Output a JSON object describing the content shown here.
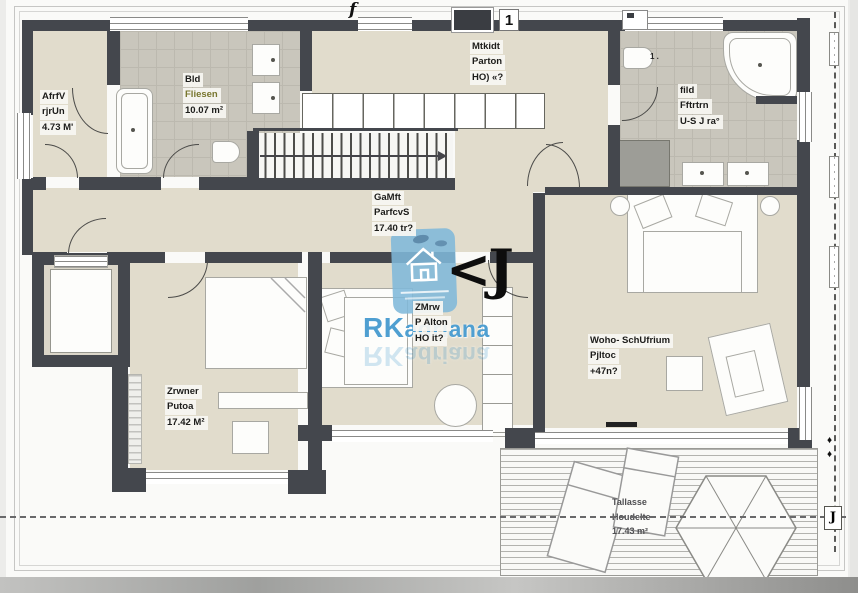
{
  "plan": {
    "rooms": {
      "entry": {
        "l1": "AfrfV",
        "l2": "rjrUn",
        "l3": "4.73 M'"
      },
      "bath1": {
        "l1": "Bld",
        "l2": "Fliesen",
        "l3": "10.07 m²"
      },
      "kitchen": {
        "l1": "Mtkidt",
        "l2": "Parton",
        "l3": "HO) «?"
      },
      "bath2": {
        "l1": "fild",
        "l2": "Fftrtrn",
        "l3": "U-S J ra°"
      },
      "hall": {
        "l1": "GaMft",
        "l2": "ParfcvS",
        "l3": "17.40 tr?"
      },
      "room_mid": {
        "l1": "ZMrw",
        "l2": "P Alton",
        "l3": "HO it?"
      },
      "living": {
        "l1": "Woho- SchUfrium",
        "l2": "Pjltoc",
        "l3": "+47n?"
      },
      "room_left": {
        "l1": "Zrwner",
        "l2": "Putoa",
        "l3": "17.42 M²"
      },
      "terrace": {
        "l1": "Tallasse",
        "l2": "Houdelte",
        "l3": "17.43 m²"
      }
    },
    "annotations": {
      "window_f": "f",
      "window_one": "1",
      "big_mark": "<J",
      "bath2_fixture": "1 .",
      "dim_label_j": "J",
      "diamond": "♦"
    },
    "watermark": {
      "brand_lead": "RK",
      "brand_rest": "adriana"
    },
    "colors": {
      "wall": "#44474d",
      "floor_beige": "#e1dccc",
      "tile_grey": "#c9c6bc",
      "watermark_blue": "#7fb8d9",
      "brand_blue": "#4f9fd1",
      "fliesen_text": "#78762e"
    }
  }
}
